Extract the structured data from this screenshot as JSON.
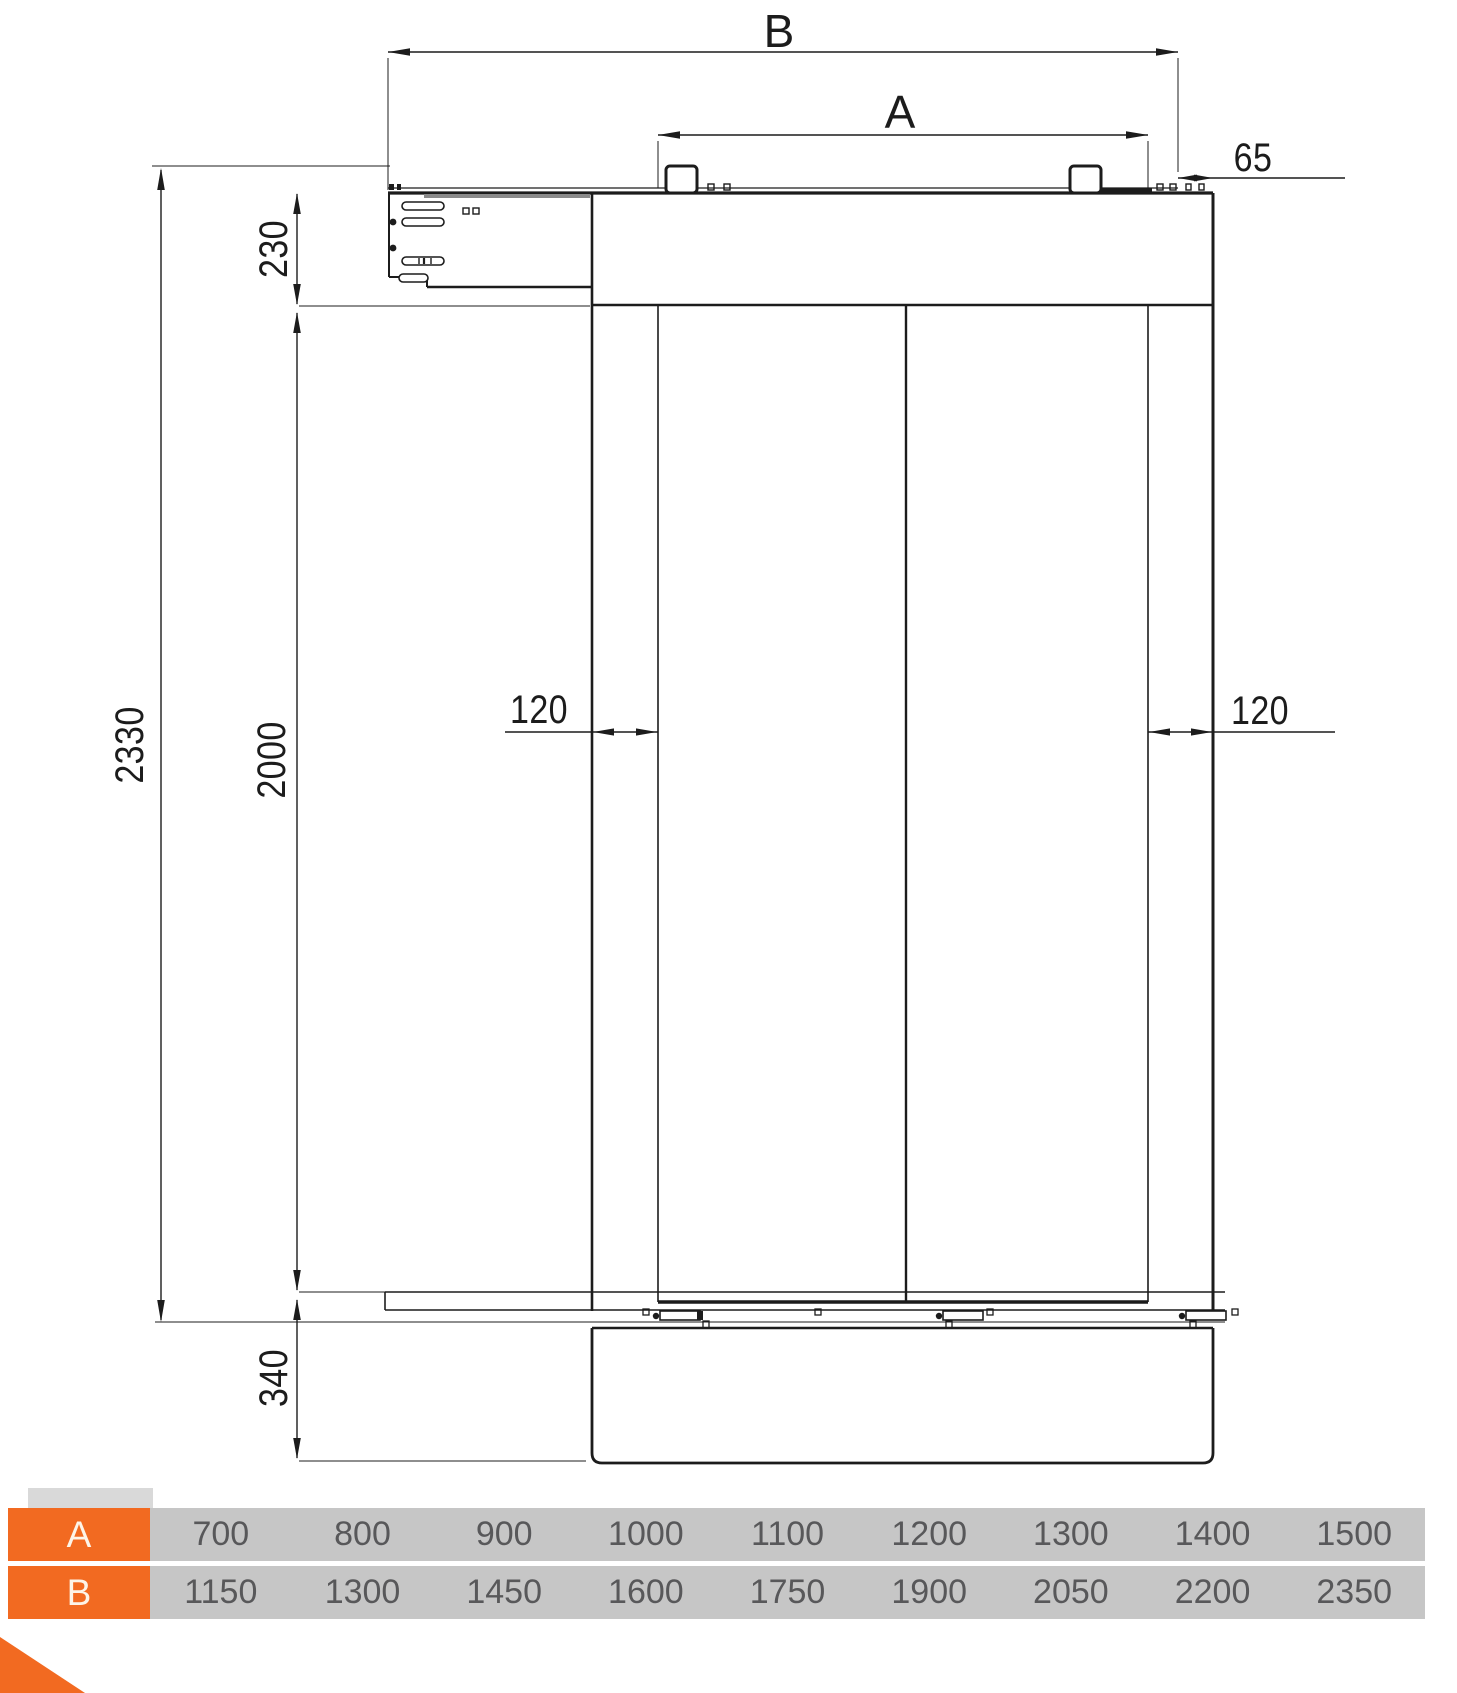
{
  "colors": {
    "accent_orange": "#F26A21",
    "row_gray": "#C6C6C6",
    "tab_gray": "#D9D9D9",
    "line": "#1C1C1C",
    "value_text": "#58585A",
    "header_text": "#FDF4E8",
    "bg": "#FFFFFF"
  },
  "drawing": {
    "labels": {
      "width_b": "B",
      "width_a": "A",
      "offset_right": "65",
      "header_height": "230",
      "total_height": "2330",
      "door_height": "2000",
      "bottom_height": "340",
      "overlap_left": "120",
      "overlap_right": "120"
    }
  },
  "table": {
    "rows": [
      {
        "header": "A",
        "values": [
          "700",
          "800",
          "900",
          "1000",
          "1100",
          "1200",
          "1300",
          "1400",
          "1500"
        ]
      },
      {
        "header": "B",
        "values": [
          "1150",
          "1300",
          "1450",
          "1600",
          "1750",
          "1900",
          "2050",
          "2200",
          "2350"
        ]
      }
    ]
  }
}
